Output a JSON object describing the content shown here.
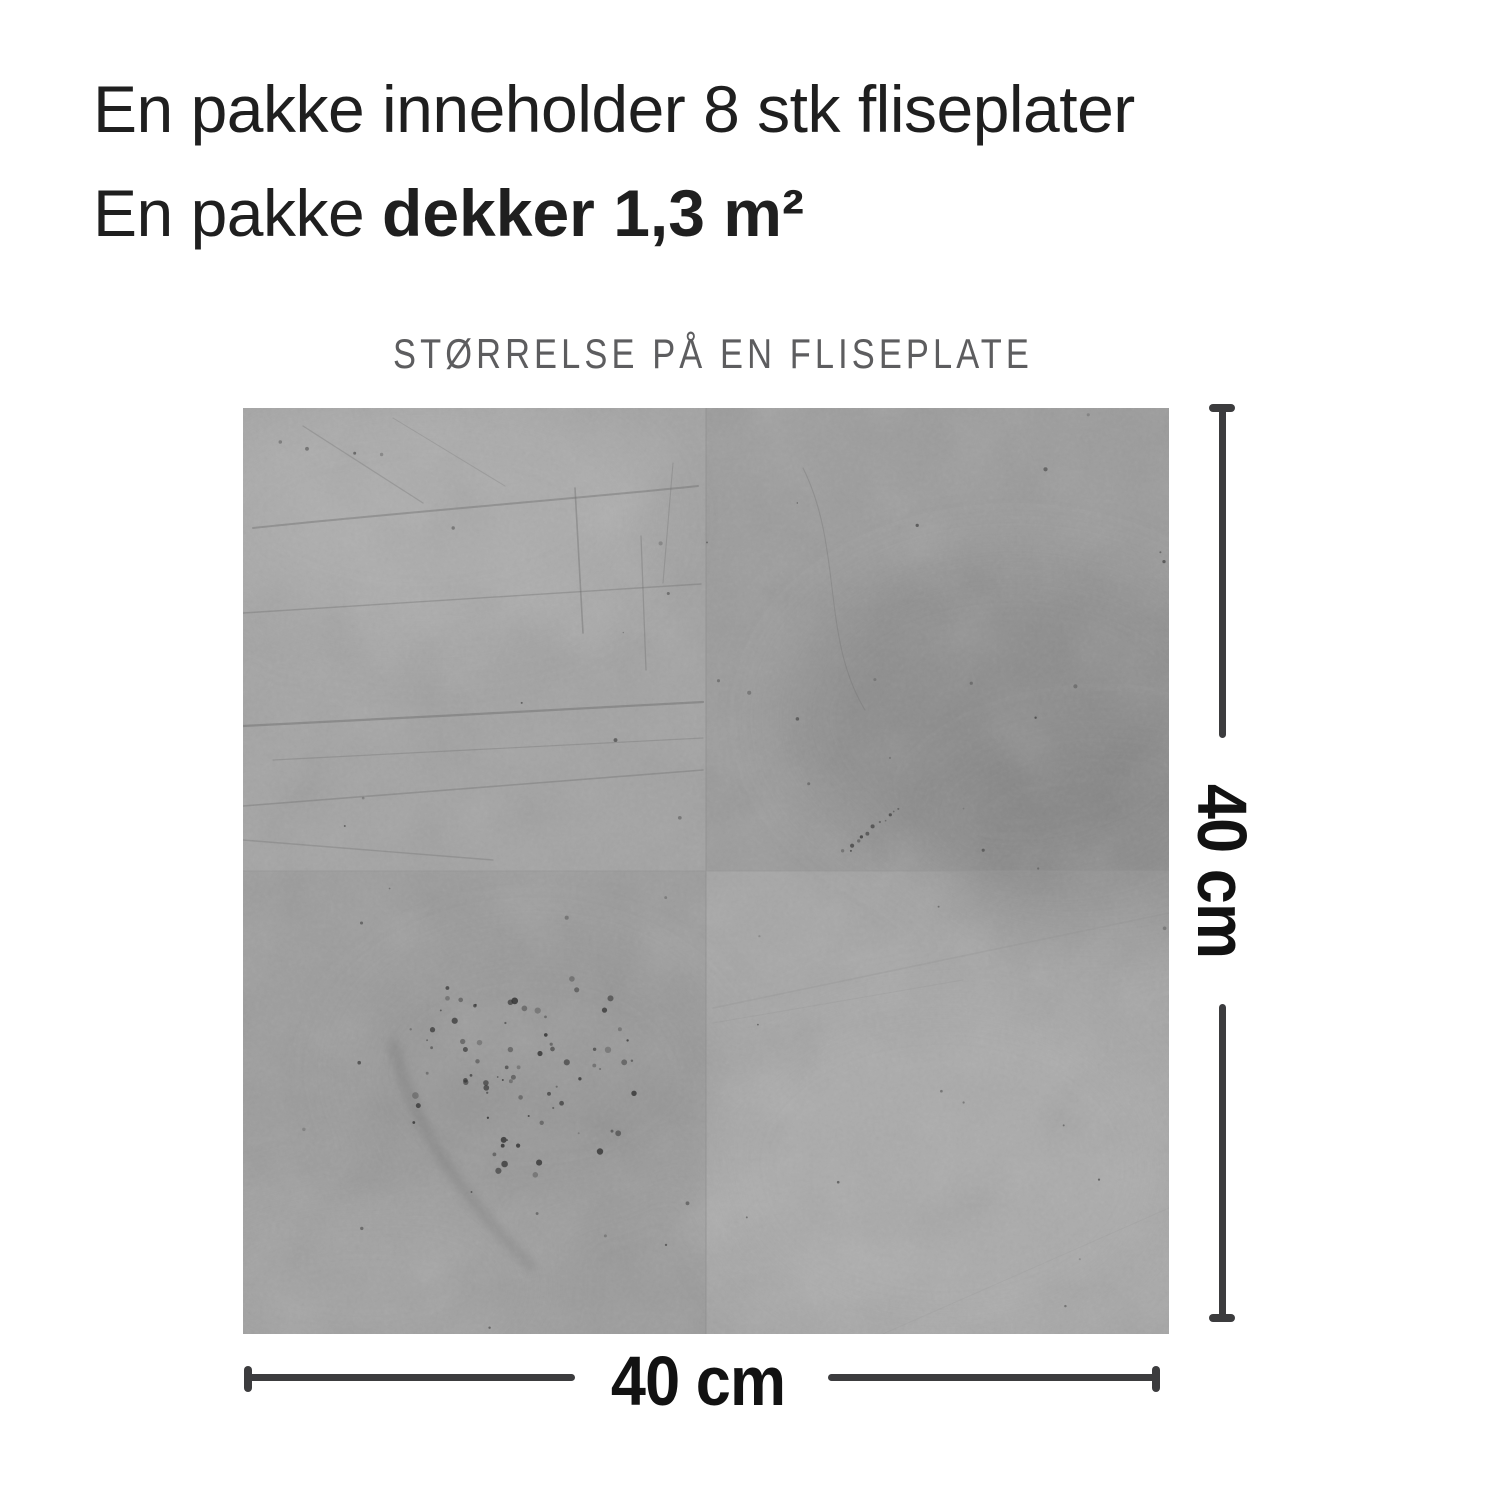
{
  "colors": {
    "background": "#ffffff",
    "heading_text": "#1f1f1f",
    "subtitle_text": "#5d5d5f",
    "dimension_line": "#3c3c3e",
    "dimension_label_text": "#121212",
    "tile_top_left": "#a3a3a3",
    "tile_top_right": "#9c9c9c",
    "tile_bottom_left": "#9c9c9c",
    "tile_bottom_right": "#a6a6a6",
    "tile_speckle": "#333333"
  },
  "heading": {
    "line1": "En pakke inneholder 8 stk fliseplater",
    "line2_regular": "En pakke",
    "line2_bold": "dekker 1,3 m²"
  },
  "diagram": {
    "subtitle": "STØRRELSE PÅ EN FLISEPLATE",
    "height_label": "40 cm",
    "width_label": "40 cm"
  }
}
